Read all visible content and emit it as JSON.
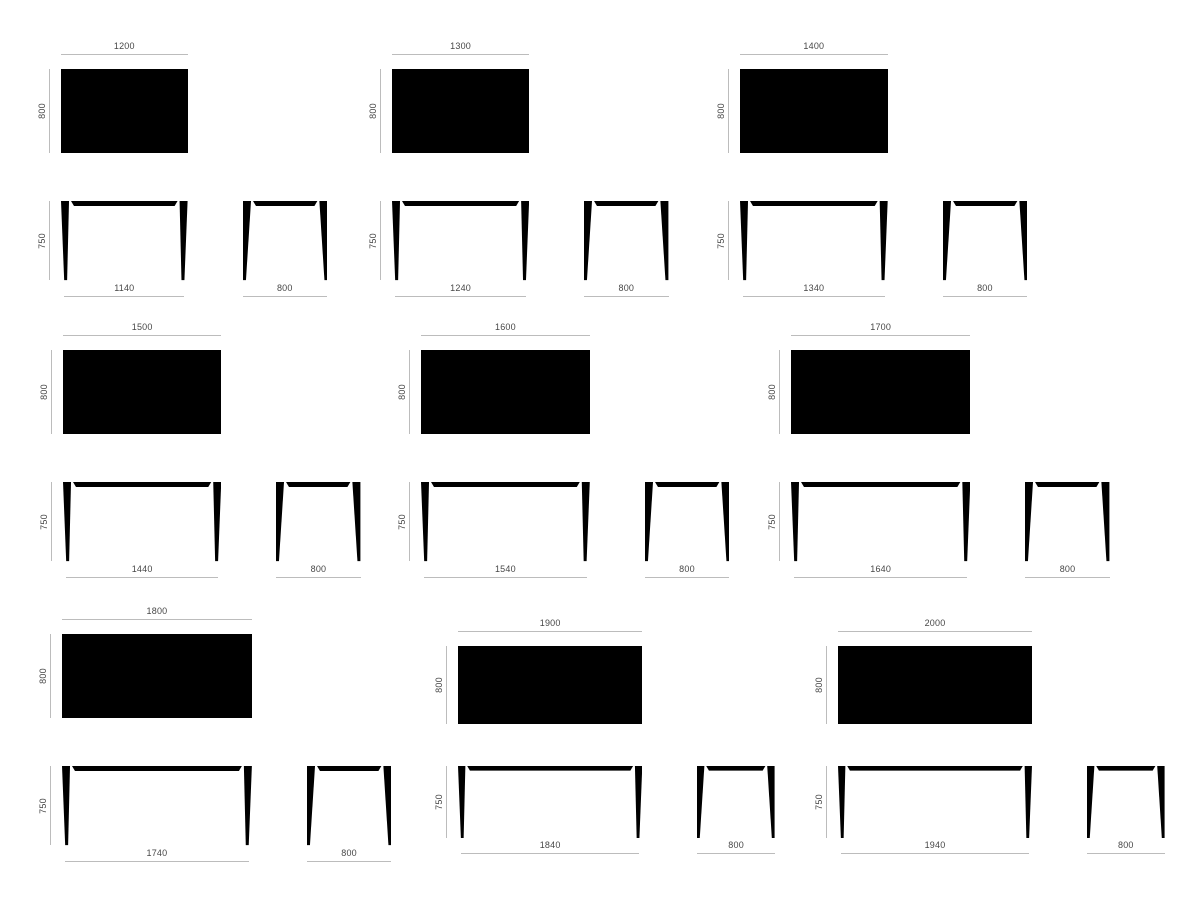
{
  "colors": {
    "background": "#ffffff",
    "shape": "#000000",
    "dim_line": "#bcbcbc",
    "dim_text": "#474747"
  },
  "variants": [
    {
      "id": "table-1200",
      "top_view": {
        "width": "1200",
        "depth": "800"
      },
      "front_view": {
        "height": "750",
        "base_width": "1140"
      },
      "side_view": {
        "base_width": "800"
      }
    },
    {
      "id": "table-1300",
      "top_view": {
        "width": "1300",
        "depth": "800"
      },
      "front_view": {
        "height": "750",
        "base_width": "1240"
      },
      "side_view": {
        "base_width": "800"
      }
    },
    {
      "id": "table-1400",
      "top_view": {
        "width": "1400",
        "depth": "800"
      },
      "front_view": {
        "height": "750",
        "base_width": "1340"
      },
      "side_view": {
        "base_width": "800"
      }
    },
    {
      "id": "table-1500",
      "top_view": {
        "width": "1500",
        "depth": "800"
      },
      "front_view": {
        "height": "750",
        "base_width": "1440"
      },
      "side_view": {
        "base_width": "800"
      }
    },
    {
      "id": "table-1600",
      "top_view": {
        "width": "1600",
        "depth": "800"
      },
      "front_view": {
        "height": "750",
        "base_width": "1540"
      },
      "side_view": {
        "base_width": "800"
      }
    },
    {
      "id": "table-1700",
      "top_view": {
        "width": "1700",
        "depth": "800"
      },
      "front_view": {
        "height": "750",
        "base_width": "1640"
      },
      "side_view": {
        "base_width": "800"
      }
    },
    {
      "id": "table-1800",
      "top_view": {
        "width": "1800",
        "depth": "800"
      },
      "front_view": {
        "height": "750",
        "base_width": "1740"
      },
      "side_view": {
        "base_width": "800"
      }
    },
    {
      "id": "table-1900",
      "top_view": {
        "width": "1900",
        "depth": "800"
      },
      "front_view": {
        "height": "750",
        "base_width": "1840"
      },
      "side_view": {
        "base_width": "800"
      }
    },
    {
      "id": "table-2000",
      "top_view": {
        "width": "2000",
        "depth": "800"
      },
      "front_view": {
        "height": "750",
        "base_width": "1940"
      },
      "side_view": {
        "base_width": "800"
      }
    }
  ]
}
